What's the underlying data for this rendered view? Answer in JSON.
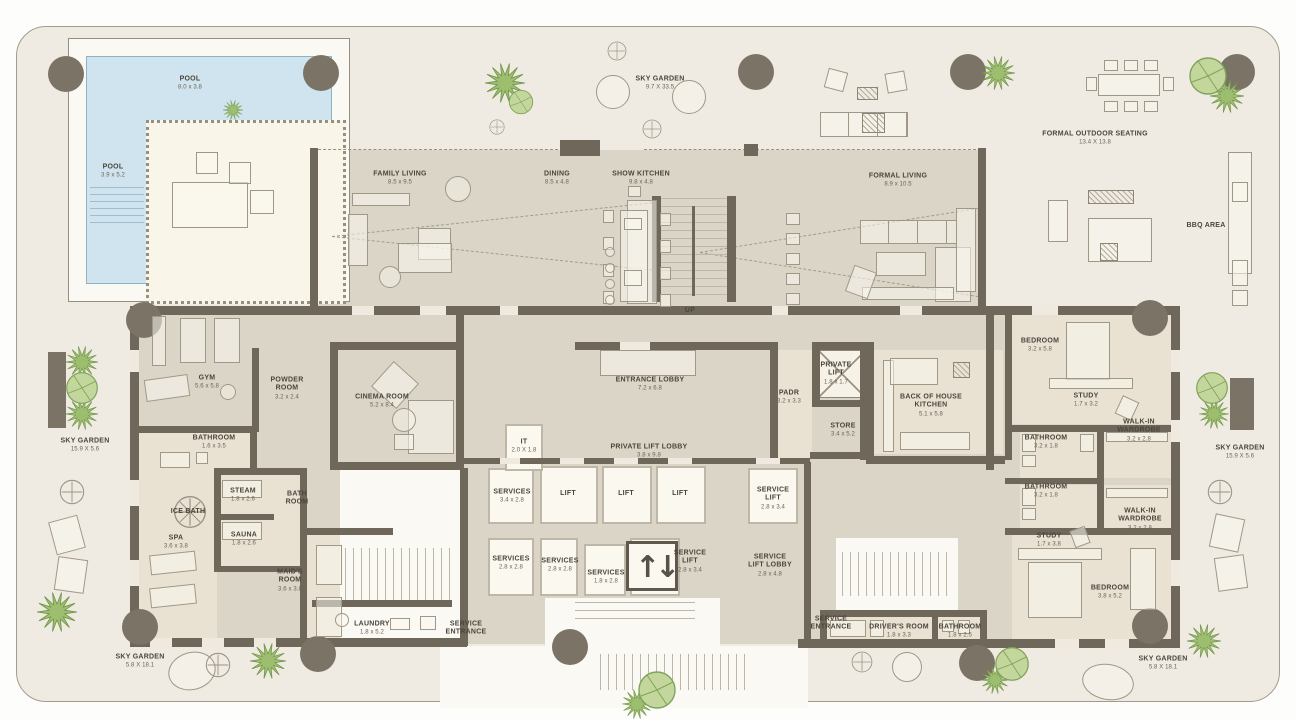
{
  "plan_type": "residential-floor-plan",
  "colors": {
    "terrace": "#f0ebe2",
    "floor": "#dbd5c7",
    "wall": "#6e675a",
    "pool": "#cfe4ee",
    "core_white": "#fbf8f0",
    "column": "#7b7366",
    "greenery": "#9dbd6f",
    "label_text": "#4a453c"
  },
  "icons": {
    "up_arrow": "↑",
    "down_arrow": "↓"
  },
  "labels": [
    {
      "name": "pool-top",
      "text": "POOL",
      "dims": "8.0 x 3.8",
      "x": 190,
      "y": 84
    },
    {
      "name": "pool-left",
      "text": "POOL",
      "dims": "3.9 x 5.2",
      "x": 113,
      "y": 172
    },
    {
      "name": "sky-garden-top",
      "text": "SKY GARDEN",
      "dims": "9.7 X 33.5",
      "x": 660,
      "y": 84
    },
    {
      "name": "formal-outdoor-seating",
      "text": "FORMAL OUTDOOR SEATING",
      "dims": "13.4 X 13.8",
      "x": 1095,
      "y": 139
    },
    {
      "name": "bbq-area",
      "text": "BBQ AREA",
      "x": 1206,
      "y": 226
    },
    {
      "name": "family-living",
      "text": "FAMILY LIVING",
      "dims": "8.5 x 9.5",
      "x": 400,
      "y": 179
    },
    {
      "name": "dining",
      "text": "DINING",
      "dims": "8.5 x 4.8",
      "x": 557,
      "y": 179
    },
    {
      "name": "show-kitchen",
      "text": "SHOW KITCHEN",
      "dims": "9.8 x 4.8",
      "x": 641,
      "y": 179
    },
    {
      "name": "formal-living",
      "text": "FORMAL LIVING",
      "dims": "8.9 x 10.5",
      "x": 898,
      "y": 181
    },
    {
      "name": "up",
      "text": "UP",
      "x": 690,
      "y": 311
    },
    {
      "name": "gym",
      "text": "GYM",
      "dims": "5.6 x 5.8",
      "x": 207,
      "y": 383
    },
    {
      "name": "powder-room",
      "text": "POWDER\nROOM",
      "dims": "3.2 x 2.4",
      "x": 287,
      "y": 389
    },
    {
      "name": "cinema-room",
      "text": "CINEMA ROOM",
      "dims": "5.2 x 8.4",
      "x": 382,
      "y": 402
    },
    {
      "name": "bathroom-gym",
      "text": "BATHROOM",
      "dims": "1.6 x 3.5",
      "x": 214,
      "y": 443
    },
    {
      "name": "steam",
      "text": "STEAM",
      "dims": "1.8 x 2.6",
      "x": 243,
      "y": 496
    },
    {
      "name": "sauna",
      "text": "SAUNA",
      "dims": "1.8 x 2.6",
      "x": 244,
      "y": 540
    },
    {
      "name": "ice-bath",
      "text": "ICE BATH",
      "x": 188,
      "y": 512
    },
    {
      "name": "spa",
      "text": "SPA",
      "dims": "3.6 x 3.8",
      "x": 176,
      "y": 543
    },
    {
      "name": "bath-room",
      "text": "BATH\nROOM",
      "x": 297,
      "y": 499
    },
    {
      "name": "maids-room",
      "text": "MAID'S\nROOM",
      "dims": "3.6 x 3.8",
      "x": 290,
      "y": 581
    },
    {
      "name": "laundry",
      "text": "LAUNDRY",
      "dims": "1.8 x 5.2",
      "x": 372,
      "y": 629
    },
    {
      "name": "service-entrance-left",
      "text": "SERVICE\nENTRANCE",
      "x": 466,
      "y": 629
    },
    {
      "name": "it-room",
      "text": "IT",
      "dims": "2.0 X 1.8",
      "x": 524,
      "y": 447
    },
    {
      "name": "entrance-lobby",
      "text": "ENTRANCE LOBBY",
      "dims": "7.2 x 6.8",
      "x": 650,
      "y": 385
    },
    {
      "name": "private-lift-lobby",
      "text": "PRIVATE LIFT LOBBY",
      "dims": "3.8 x 9.8",
      "x": 649,
      "y": 452
    },
    {
      "name": "padr",
      "text": "PADR",
      "dims": "3.2 x 3.3",
      "x": 789,
      "y": 398
    },
    {
      "name": "private-lift",
      "text": "PRIVATE\nLIFT",
      "dims": "1.8 x 1.7",
      "x": 836,
      "y": 374
    },
    {
      "name": "store",
      "text": "STORE",
      "dims": "3.4 x 5.2",
      "x": 843,
      "y": 431
    },
    {
      "name": "services-1",
      "text": "SERVICES",
      "dims": "3.4 x 2.8",
      "x": 512,
      "y": 497
    },
    {
      "name": "lift-1",
      "text": "LIFT",
      "x": 568,
      "y": 494
    },
    {
      "name": "lift-2",
      "text": "LIFT",
      "x": 626,
      "y": 494
    },
    {
      "name": "lift-3",
      "text": "LIFT",
      "x": 680,
      "y": 494
    },
    {
      "name": "service-lift-right",
      "text": "SERVICE\nLIFT",
      "dims": "2.8 x 3.4",
      "x": 773,
      "y": 499
    },
    {
      "name": "services-2",
      "text": "SERVICES",
      "dims": "2.8 x 2.8",
      "x": 511,
      "y": 564
    },
    {
      "name": "services-3",
      "text": "SERVICES",
      "dims": "2.8 x 2.8",
      "x": 560,
      "y": 566
    },
    {
      "name": "services-4",
      "text": "SERVICES",
      "dims": "1.8 x 2.8",
      "x": 606,
      "y": 578
    },
    {
      "name": "service-lift-center",
      "text": "SERVICE\nLIFT",
      "dims": "2.8 x 3.4",
      "x": 690,
      "y": 562
    },
    {
      "name": "service-lift-lobby",
      "text": "SERVICE\nLIFT LOBBY",
      "dims": "2.8 x 4.8",
      "x": 770,
      "y": 566
    },
    {
      "name": "back-of-house-kitchen",
      "text": "BACK OF HOUSE\nKITCHEN",
      "dims": "5.1 x 5.8",
      "x": 931,
      "y": 406
    },
    {
      "name": "bedroom-top",
      "text": "BEDROOM",
      "dims": "3.2 x 5.8",
      "x": 1040,
      "y": 346
    },
    {
      "name": "study-top",
      "text": "STUDY",
      "dims": "1.7 x 3.2",
      "x": 1086,
      "y": 401
    },
    {
      "name": "walk-in-wardrobe-top",
      "text": "WALK-IN\nWARDROBE",
      "dims": "3.2 x 2.8",
      "x": 1139,
      "y": 431
    },
    {
      "name": "bathroom-right-1",
      "text": "BATHROOM",
      "dims": "3.2 x 1.8",
      "x": 1046,
      "y": 443
    },
    {
      "name": "bathroom-right-2",
      "text": "BATHROOM",
      "dims": "3.2 x 1.8",
      "x": 1046,
      "y": 492
    },
    {
      "name": "walk-in-wardrobe-bottom",
      "text": "WALK-IN\nWARDROBE",
      "dims": "3.2 x 2.8",
      "x": 1140,
      "y": 520
    },
    {
      "name": "study-bottom",
      "text": "STUDY",
      "dims": "1.7 x 3.8",
      "x": 1049,
      "y": 541
    },
    {
      "name": "bedroom-bottom",
      "text": "BEDROOM",
      "dims": "3.8 x 5.2",
      "x": 1110,
      "y": 593
    },
    {
      "name": "drivers-room",
      "text": "DRIVER'S ROOM",
      "dims": "1.8 x 3.3",
      "x": 899,
      "y": 632
    },
    {
      "name": "bathroom-bottom-right",
      "text": "BATHROOM",
      "dims": "1.8 x 2.5",
      "x": 960,
      "y": 632
    },
    {
      "name": "service-entrance-right",
      "text": "SERVICE\nENTRANCE",
      "x": 831,
      "y": 624
    },
    {
      "name": "sky-garden-left",
      "text": "SKY GARDEN",
      "dims": "15.9 X 5.6",
      "x": 85,
      "y": 446
    },
    {
      "name": "sky-garden-right",
      "text": "SKY GARDEN",
      "dims": "15.9 X 5.6",
      "x": 1240,
      "y": 453
    },
    {
      "name": "sky-garden-bottom-left",
      "text": "SKY GARDEN",
      "dims": "5.8 X 18.1",
      "x": 140,
      "y": 662
    },
    {
      "name": "sky-garden-bottom-right",
      "text": "SKY GARDEN",
      "dims": "5.8 X 18.1",
      "x": 1163,
      "y": 664
    }
  ]
}
